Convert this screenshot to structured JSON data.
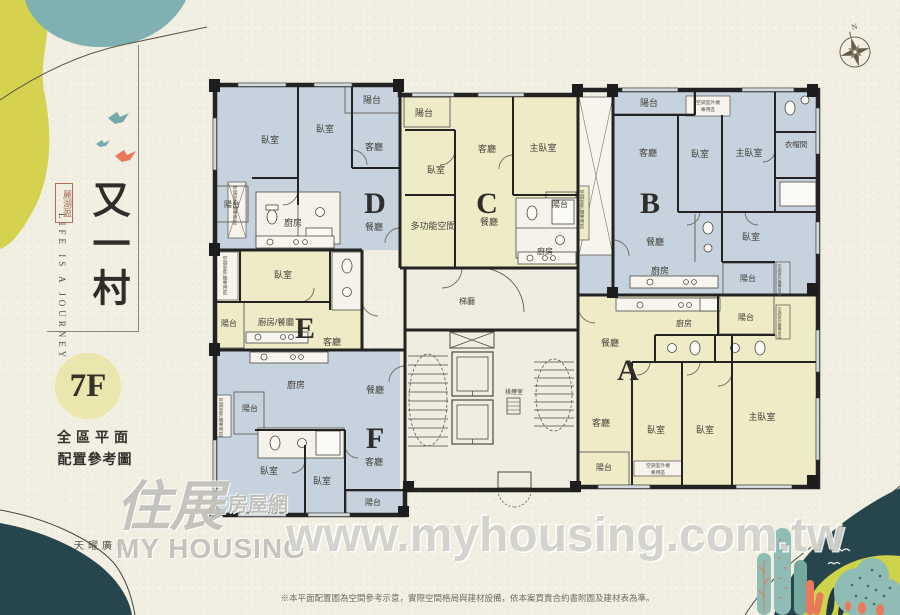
{
  "sidebar": {
    "tagline": "LIFE IS A JOURNEY",
    "seal_text": "麗湖盈",
    "project_title": "又一村",
    "floor_label": "7F",
    "subtitle_line1": "全區平面",
    "subtitle_line2": "配置參考圖",
    "agency": "天曜廣告"
  },
  "plan": {
    "unit_letters": {
      "A": "A",
      "B": "B",
      "C": "C",
      "D": "D",
      "E": "E",
      "F": "F"
    },
    "room_labels": {
      "bedroom": "臥室",
      "master_bedroom": "主臥室",
      "living": "客廳",
      "dining": "餐廳",
      "kitchen": "廚房",
      "balcony": "陽台",
      "multi_purpose": "多功能空間",
      "closet": "衣帽間",
      "kitchen_dining": "廚房/餐廳",
      "elevator_hall": "梯廳",
      "smoke_room": "排煙室",
      "ac_area": "空調室外機專用區",
      "ac_line1": "空調室外機",
      "ac_line2": "專用區"
    },
    "compass_label": "N"
  },
  "watermark": {
    "url": "www.myhousing.com.tw",
    "logo_cn_main": "住展",
    "logo_cn_sub": "房屋網",
    "logo_en": "MY HOUSING"
  },
  "footnote": "※本平面配置圖為空間參考示意，實際空間格局與建材設備，依本案買賣合約書附圖及建材表為準。",
  "colors": {
    "unit_blue": "#c6d3de",
    "unit_yellow": "#eeebc6",
    "wall": "#232323",
    "paper": "#f1eee2",
    "accent_yellow": "#d5d24f",
    "accent_teal": "#7fb1b2",
    "accent_dark_teal": "#27454d",
    "accent_orange": "#e8795a"
  }
}
